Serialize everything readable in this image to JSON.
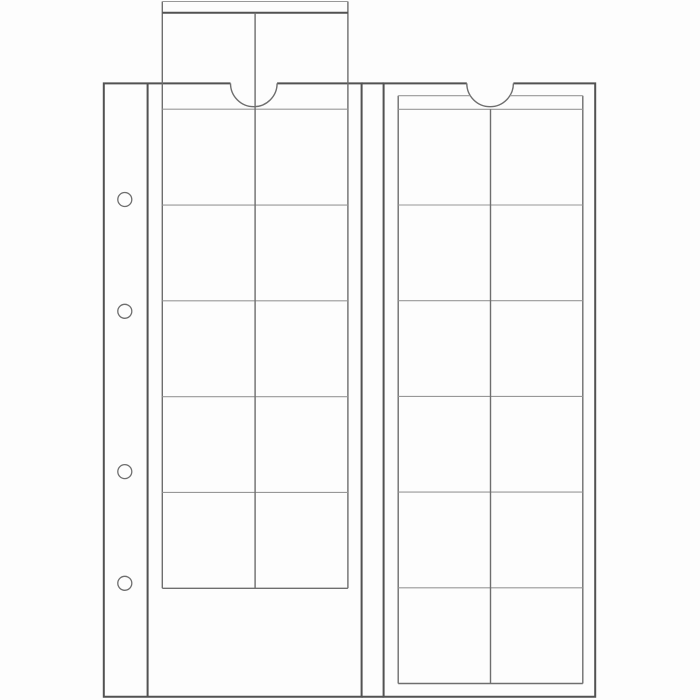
{
  "colors": {
    "paper": "#fdfdfd",
    "line_strong": "#525252",
    "line_mid": "#6e6e6e",
    "line_light": "#989898"
  },
  "drawing": {
    "kind": "technical-line-drawing",
    "subject": "two coin-album pocket sheets, side by side",
    "left_sheet": {
      "pocket_rows": 5,
      "pocket_columns": 2,
      "punch_holes": 4,
      "slide_strip_pulled_out": true,
      "thumb_notch": true
    },
    "right_sheet": {
      "pocket_rows": 6,
      "pocket_columns": 2,
      "punch_holes": 0,
      "slide_strip_pulled_out": false,
      "thumb_notch": true
    }
  }
}
